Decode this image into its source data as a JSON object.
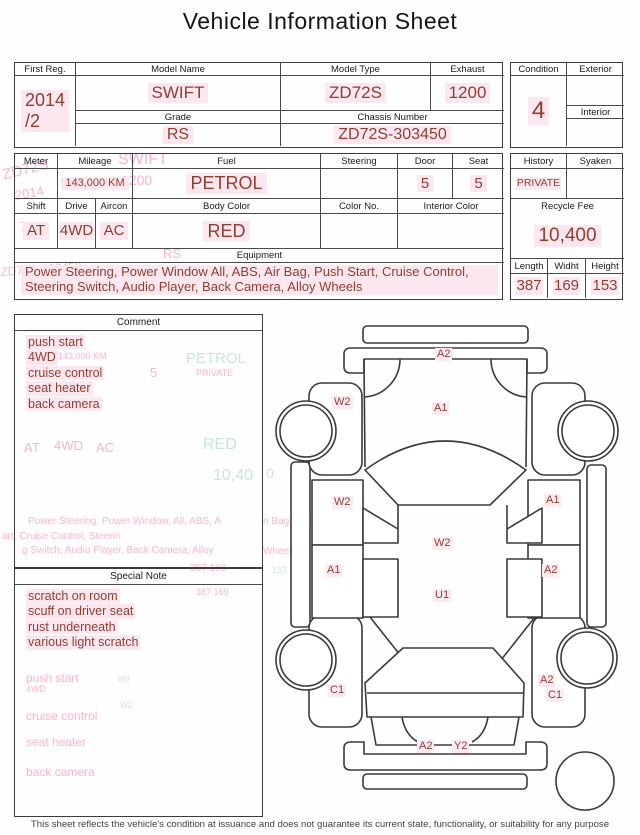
{
  "title": "Vehicle Information Sheet",
  "colors": {
    "value_text": "#8e3f2f",
    "highlight": "#fce7f0",
    "ghost_pink": "#f5b6cc",
    "ghost_cyan": "#c5e6de"
  },
  "table1": {
    "first_reg_label": "First Reg.",
    "first_reg_value": "2014\n/2",
    "model_name_label": "Model Name",
    "model_name_value": "SWIFT",
    "model_type_label": "Model Type",
    "model_type_value": "ZD72S",
    "exhaust_label": "Exhaust",
    "exhaust_value": "1200",
    "grade_label": "Grade",
    "grade_value": "RS",
    "chassis_label": "Chassis Number",
    "chassis_value": "ZD72S-303450",
    "condition_label": "Condition",
    "condition_value": "4",
    "exterior_label": "Exterior",
    "exterior_value": "",
    "interior_label": "Interior",
    "interior_value": ""
  },
  "table2": {
    "meter_label": "Meter",
    "meter_value": "",
    "mileage_label": "Mileage",
    "mileage_value": "143,000 KM",
    "fuel_label": "Fuel",
    "fuel_value": "PETROL",
    "steering_label": "Steering",
    "steering_value": "",
    "door_label": "Door",
    "door_value": "5",
    "seat_label": "Seat",
    "seat_value": "5",
    "shift_label": "Shift",
    "shift_value": "AT",
    "drive_label": "Drive",
    "drive_value": "4WD",
    "aircon_label": "Aircon",
    "aircon_value": "AC",
    "body_color_label": "Body Color",
    "body_color_value": "RED",
    "color_no_label": "Color No.",
    "color_no_value": "",
    "interior_color_label": "Interior Color",
    "interior_color_value": "",
    "equipment_label": "Equipment",
    "equipment_value": "Power Steering, Power Window  All, ABS, Air Bag, Push Start, Cruise Control, Steering Switch, Audio Player, Back Camera, Alloy Wheels",
    "history_label": "History",
    "history_value": "PRIVATE",
    "syaken_label": "Syaken",
    "syaken_value": "",
    "recycle_label": "Recycle Fee",
    "recycle_value": "10,400",
    "length_label": "Length",
    "length_value": "387",
    "width_label": "Widht",
    "width_value": "169",
    "height_label": "Height",
    "height_value": "153"
  },
  "comment": {
    "header": "Comment",
    "lines": [
      "push start",
      "4WD",
      "cruise control",
      "seat heater",
      "back camera"
    ]
  },
  "special_note": {
    "header": "Special Note",
    "lines": [
      "scratch on room",
      "scuff on driver seat",
      "rust underneath",
      "various light scratch"
    ]
  },
  "diagram": {
    "labels": [
      {
        "text": "A2",
        "x": 170,
        "y": 33
      },
      {
        "text": "W2",
        "x": 67,
        "y": 81
      },
      {
        "text": "A1",
        "x": 167,
        "y": 87
      },
      {
        "text": "W2",
        "x": 67,
        "y": 181
      },
      {
        "text": "A1",
        "x": 279,
        "y": 179
      },
      {
        "text": "W2",
        "x": 167,
        "y": 222
      },
      {
        "text": "A1",
        "x": 60,
        "y": 249
      },
      {
        "text": "A2",
        "x": 277,
        "y": 249
      },
      {
        "text": "U1",
        "x": 168,
        "y": 274
      },
      {
        "text": "C1",
        "x": 63,
        "y": 369
      },
      {
        "text": "A2",
        "x": 273,
        "y": 359
      },
      {
        "text": "C1",
        "x": 281,
        "y": 374
      },
      {
        "text": "A2",
        "x": 152,
        "y": 425
      },
      {
        "text": "Y2",
        "x": 187,
        "y": 425
      }
    ]
  },
  "ghosts": [
    {
      "t": "ZD72S",
      "x": 1,
      "y": 168,
      "s": 15,
      "c": "p",
      "r": -14
    },
    {
      "t": "2014",
      "x": 14,
      "y": 189,
      "s": 13,
      "c": "p",
      "r": -10
    },
    {
      "t": "72",
      "x": 20,
      "y": 220,
      "s": 13,
      "c": "p",
      "r": 0
    },
    {
      "t": "ZD72S-303450",
      "x": 0,
      "y": 266,
      "s": 12,
      "c": "p",
      "r": -4
    },
    {
      "t": "SWIFT",
      "x": 118,
      "y": 152,
      "s": 16,
      "c": "p",
      "r": 0
    },
    {
      "t": "1200",
      "x": 121,
      "y": 173,
      "s": 14,
      "c": "p",
      "r": 0
    },
    {
      "t": "RS",
      "x": 163,
      "y": 247,
      "s": 13,
      "c": "p",
      "r": 0
    },
    {
      "t": "143,000 KM",
      "x": 58,
      "y": 352,
      "s": 9,
      "c": "p",
      "r": 0
    },
    {
      "t": "PETROL",
      "x": 186,
      "y": 351,
      "s": 15,
      "c": "c",
      "r": 0
    },
    {
      "t": "5",
      "x": 84,
      "y": 368,
      "s": 13,
      "c": "p",
      "r": 0
    },
    {
      "t": "5",
      "x": 150,
      "y": 366,
      "s": 13,
      "c": "p",
      "r": 0
    },
    {
      "t": "PRIVATE",
      "x": 196,
      "y": 369,
      "s": 9,
      "c": "p",
      "r": 0
    },
    {
      "t": "AT",
      "x": 24,
      "y": 441,
      "s": 13,
      "c": "p",
      "r": 0
    },
    {
      "t": "4WD",
      "x": 54,
      "y": 439,
      "s": 13,
      "c": "p",
      "r": 0
    },
    {
      "t": "AC",
      "x": 96,
      "y": 441,
      "s": 13,
      "c": "p",
      "r": 0
    },
    {
      "t": "RED",
      "x": 203,
      "y": 437,
      "s": 16,
      "c": "c",
      "r": 0
    },
    {
      "t": "10,40",
      "x": 213,
      "y": 468,
      "s": 16,
      "c": "c",
      "r": 0
    },
    {
      "t": "Power Steering, Power Window, All, ABS, A",
      "x": 28,
      "y": 517,
      "s": 10,
      "c": "p",
      "r": 0
    },
    {
      "t": "art, Cruise Control, Steerin",
      "x": 2,
      "y": 532,
      "s": 10,
      "c": "p",
      "r": 0
    },
    {
      "t": "g Switch, Audio Player, Back Camera, Alloy",
      "x": 22,
      "y": 546,
      "s": 10,
      "c": "p",
      "r": 0
    },
    {
      "t": "387  169",
      "x": 190,
      "y": 564,
      "s": 10,
      "c": "p",
      "r": 0
    },
    {
      "t": "387  169",
      "x": 196,
      "y": 588,
      "s": 9,
      "c": "p",
      "r": 0
    },
    {
      "t": "push start",
      "x": 26,
      "y": 672,
      "s": 12,
      "c": "p",
      "r": 0
    },
    {
      "t": "4WD",
      "x": 26,
      "y": 685,
      "s": 9,
      "c": "p",
      "r": 0
    },
    {
      "t": "cruise control",
      "x": 26,
      "y": 710,
      "s": 12,
      "c": "p",
      "r": 0
    },
    {
      "t": "W2",
      "x": 120,
      "y": 702,
      "s": 8,
      "c": "c",
      "r": 0
    },
    {
      "t": "W2",
      "x": 118,
      "y": 676,
      "s": 8,
      "c": "c",
      "r": 0
    },
    {
      "t": "seat heater",
      "x": 26,
      "y": 736,
      "s": 12,
      "c": "p",
      "r": 0
    },
    {
      "t": "back camera",
      "x": 26,
      "y": 766,
      "s": 12,
      "c": "p",
      "r": 0
    },
    {
      "t": "0",
      "x": 266,
      "y": 466,
      "s": 14,
      "c": "c",
      "r": 0
    },
    {
      "t": "n Bag, Pus",
      "x": 263,
      "y": 517,
      "s": 10,
      "c": "p",
      "r": 0
    },
    {
      "t": "Wheels",
      "x": 263,
      "y": 547,
      "s": 10,
      "c": "p",
      "r": 0
    },
    {
      "t": "153",
      "x": 272,
      "y": 566,
      "s": 9,
      "c": "c",
      "r": 0
    }
  ],
  "disclaimer": "This sheet reflects the vehicle's condition at issuance and does not guarantee its current state, functionality, or suitability for any purpose"
}
